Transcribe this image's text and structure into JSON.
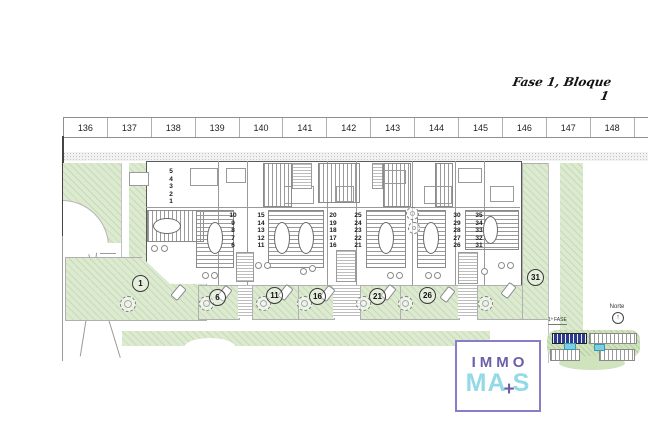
{
  "title": "Fase 1, Bloque 1",
  "ruler": {
    "cells": [
      "136",
      "137",
      "138",
      "139",
      "140",
      "141",
      "142",
      "143",
      "144",
      "145",
      "146",
      "147",
      "148",
      "149"
    ]
  },
  "plan": {
    "unit_stacks": [
      {
        "id": "units-1-5",
        "text": "5\n4\n3\n2\n1"
      },
      {
        "id": "units-6-10",
        "text": "10\n9\n8\n7\n6"
      },
      {
        "id": "units-11-15",
        "text": "15\n14\n13\n12\n11"
      },
      {
        "id": "units-16-20",
        "text": "20\n19\n18\n17\n16"
      },
      {
        "id": "units-21-25",
        "text": "25\n24\n23\n22\n21"
      },
      {
        "id": "units-26-30",
        "text": "30\n29\n28\n27\n26"
      },
      {
        "id": "units-31-35",
        "text": "35\n34\n33\n32\n31"
      }
    ],
    "plot_badges": [
      "1",
      "6",
      "11",
      "16",
      "21",
      "26",
      "31"
    ]
  },
  "compass": {
    "label": "Norte"
  },
  "minimap": {
    "phase_label": "1ª FASE"
  },
  "logo": {
    "line1": "IMMO",
    "line2_a": "MA",
    "plus": "+",
    "line2_b": "S"
  },
  "colors": {
    "garden_green": "#dcead0",
    "logo_purple": "#6a60aa",
    "logo_cyan": "#93d9e7",
    "logo_border": "#8a7cc6",
    "phase_highlight_blue": "#2b3a8f",
    "pool_cyan": "#7ad0e0"
  }
}
